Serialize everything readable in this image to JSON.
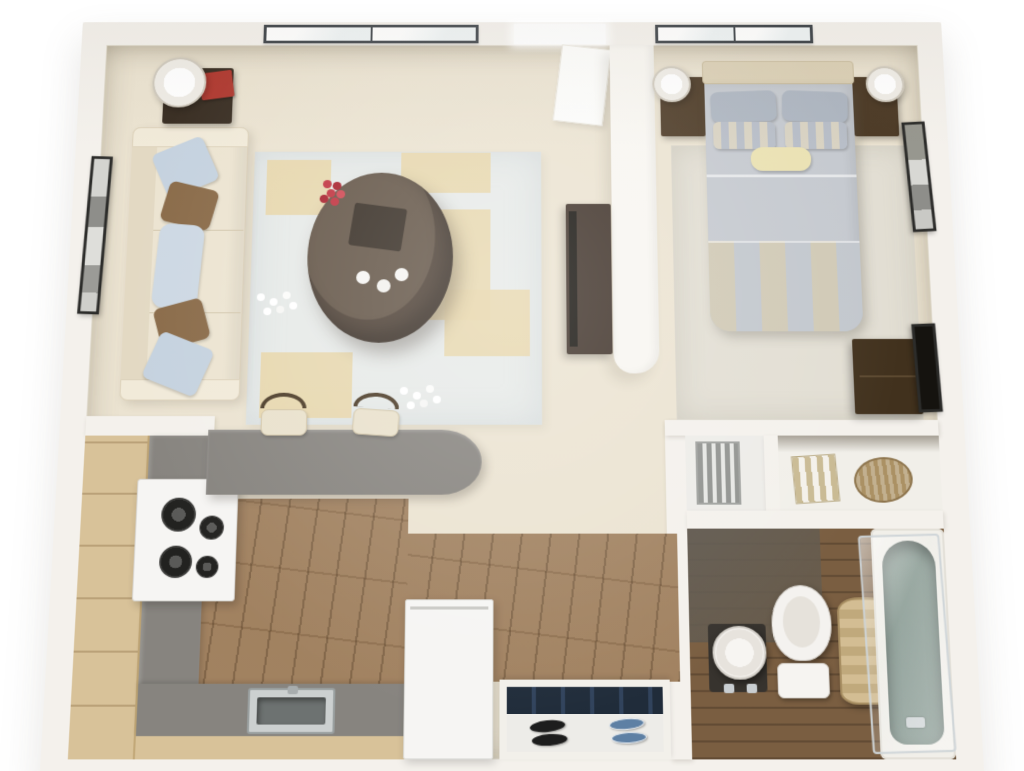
{
  "scene": {
    "title": "Studio apartment 3D floor plan",
    "view": "top-down dollhouse render",
    "background": "#ffffff"
  },
  "palette": {
    "wall": "#f4f1ec",
    "floor": "#ebe3d1",
    "rug": "#e7eae8",
    "rugAccent": "#e7d6aa",
    "wood": "#9c7b58",
    "woodDark": "#7a5e41",
    "counter": "#87847f",
    "cabinet": "#d8c299",
    "darkWood": "#40332a",
    "sofa": "#ece4d1",
    "pillowBlue": "#c5d2df",
    "pillowBrown": "#8a6b49",
    "bedGray": "#c5c9cf",
    "navy": "#202c3a",
    "shoeBlue": "#5e80a4",
    "tub": "#8fa099",
    "hamper": "#c9b288",
    "red": "#b03a31",
    "flowerRed": "#c13642",
    "frame": "#2c2c2a",
    "white": "#f6f5f3"
  },
  "architecture": {
    "skylight_left_panes": 2,
    "skylight_right_panes": 2,
    "doorway_label": "Open doorway between living room and bedroom",
    "partition_label": "Rounded partition wall with TV console"
  },
  "rooms": {
    "living": {
      "name": "Living room",
      "items": [
        "cream sofa with blue and brown pillows",
        "oval dark wood coffee table with red flowers and cups",
        "light area rug with tan accents",
        "side table with lamp and red box",
        "black framed wall art",
        "TV console on partition"
      ]
    },
    "bedroom": {
      "name": "Bedroom",
      "items": [
        "double bed with gray duvet and striped foot blanket",
        "headboard",
        "two nightstands",
        "two white lamps",
        "dark dresser",
        "framed wall art",
        "wall mirror"
      ]
    },
    "kitchen": {
      "name": "Kitchen",
      "items": [
        "tan cabinets",
        "gray L counter",
        "white range with four burners",
        "stainless sink",
        "white refrigerator",
        "gray breakfast bar with rounded end",
        "two bar stools"
      ]
    },
    "entry": {
      "name": "Entry",
      "items": [
        "recessed coat closet with navy interior",
        "black shoes pair",
        "blue shoes pair"
      ]
    },
    "closet": {
      "name": "Hall closet",
      "items": [
        "gray slatted unit",
        "white shelving",
        "striped towels",
        "wicker basket"
      ]
    },
    "bathroom": {
      "name": "Bathroom",
      "items": [
        "round pedestal sink",
        "toilet",
        "striped hamper",
        "bathtub with glass screen",
        "dark wood plank floor"
      ]
    }
  }
}
